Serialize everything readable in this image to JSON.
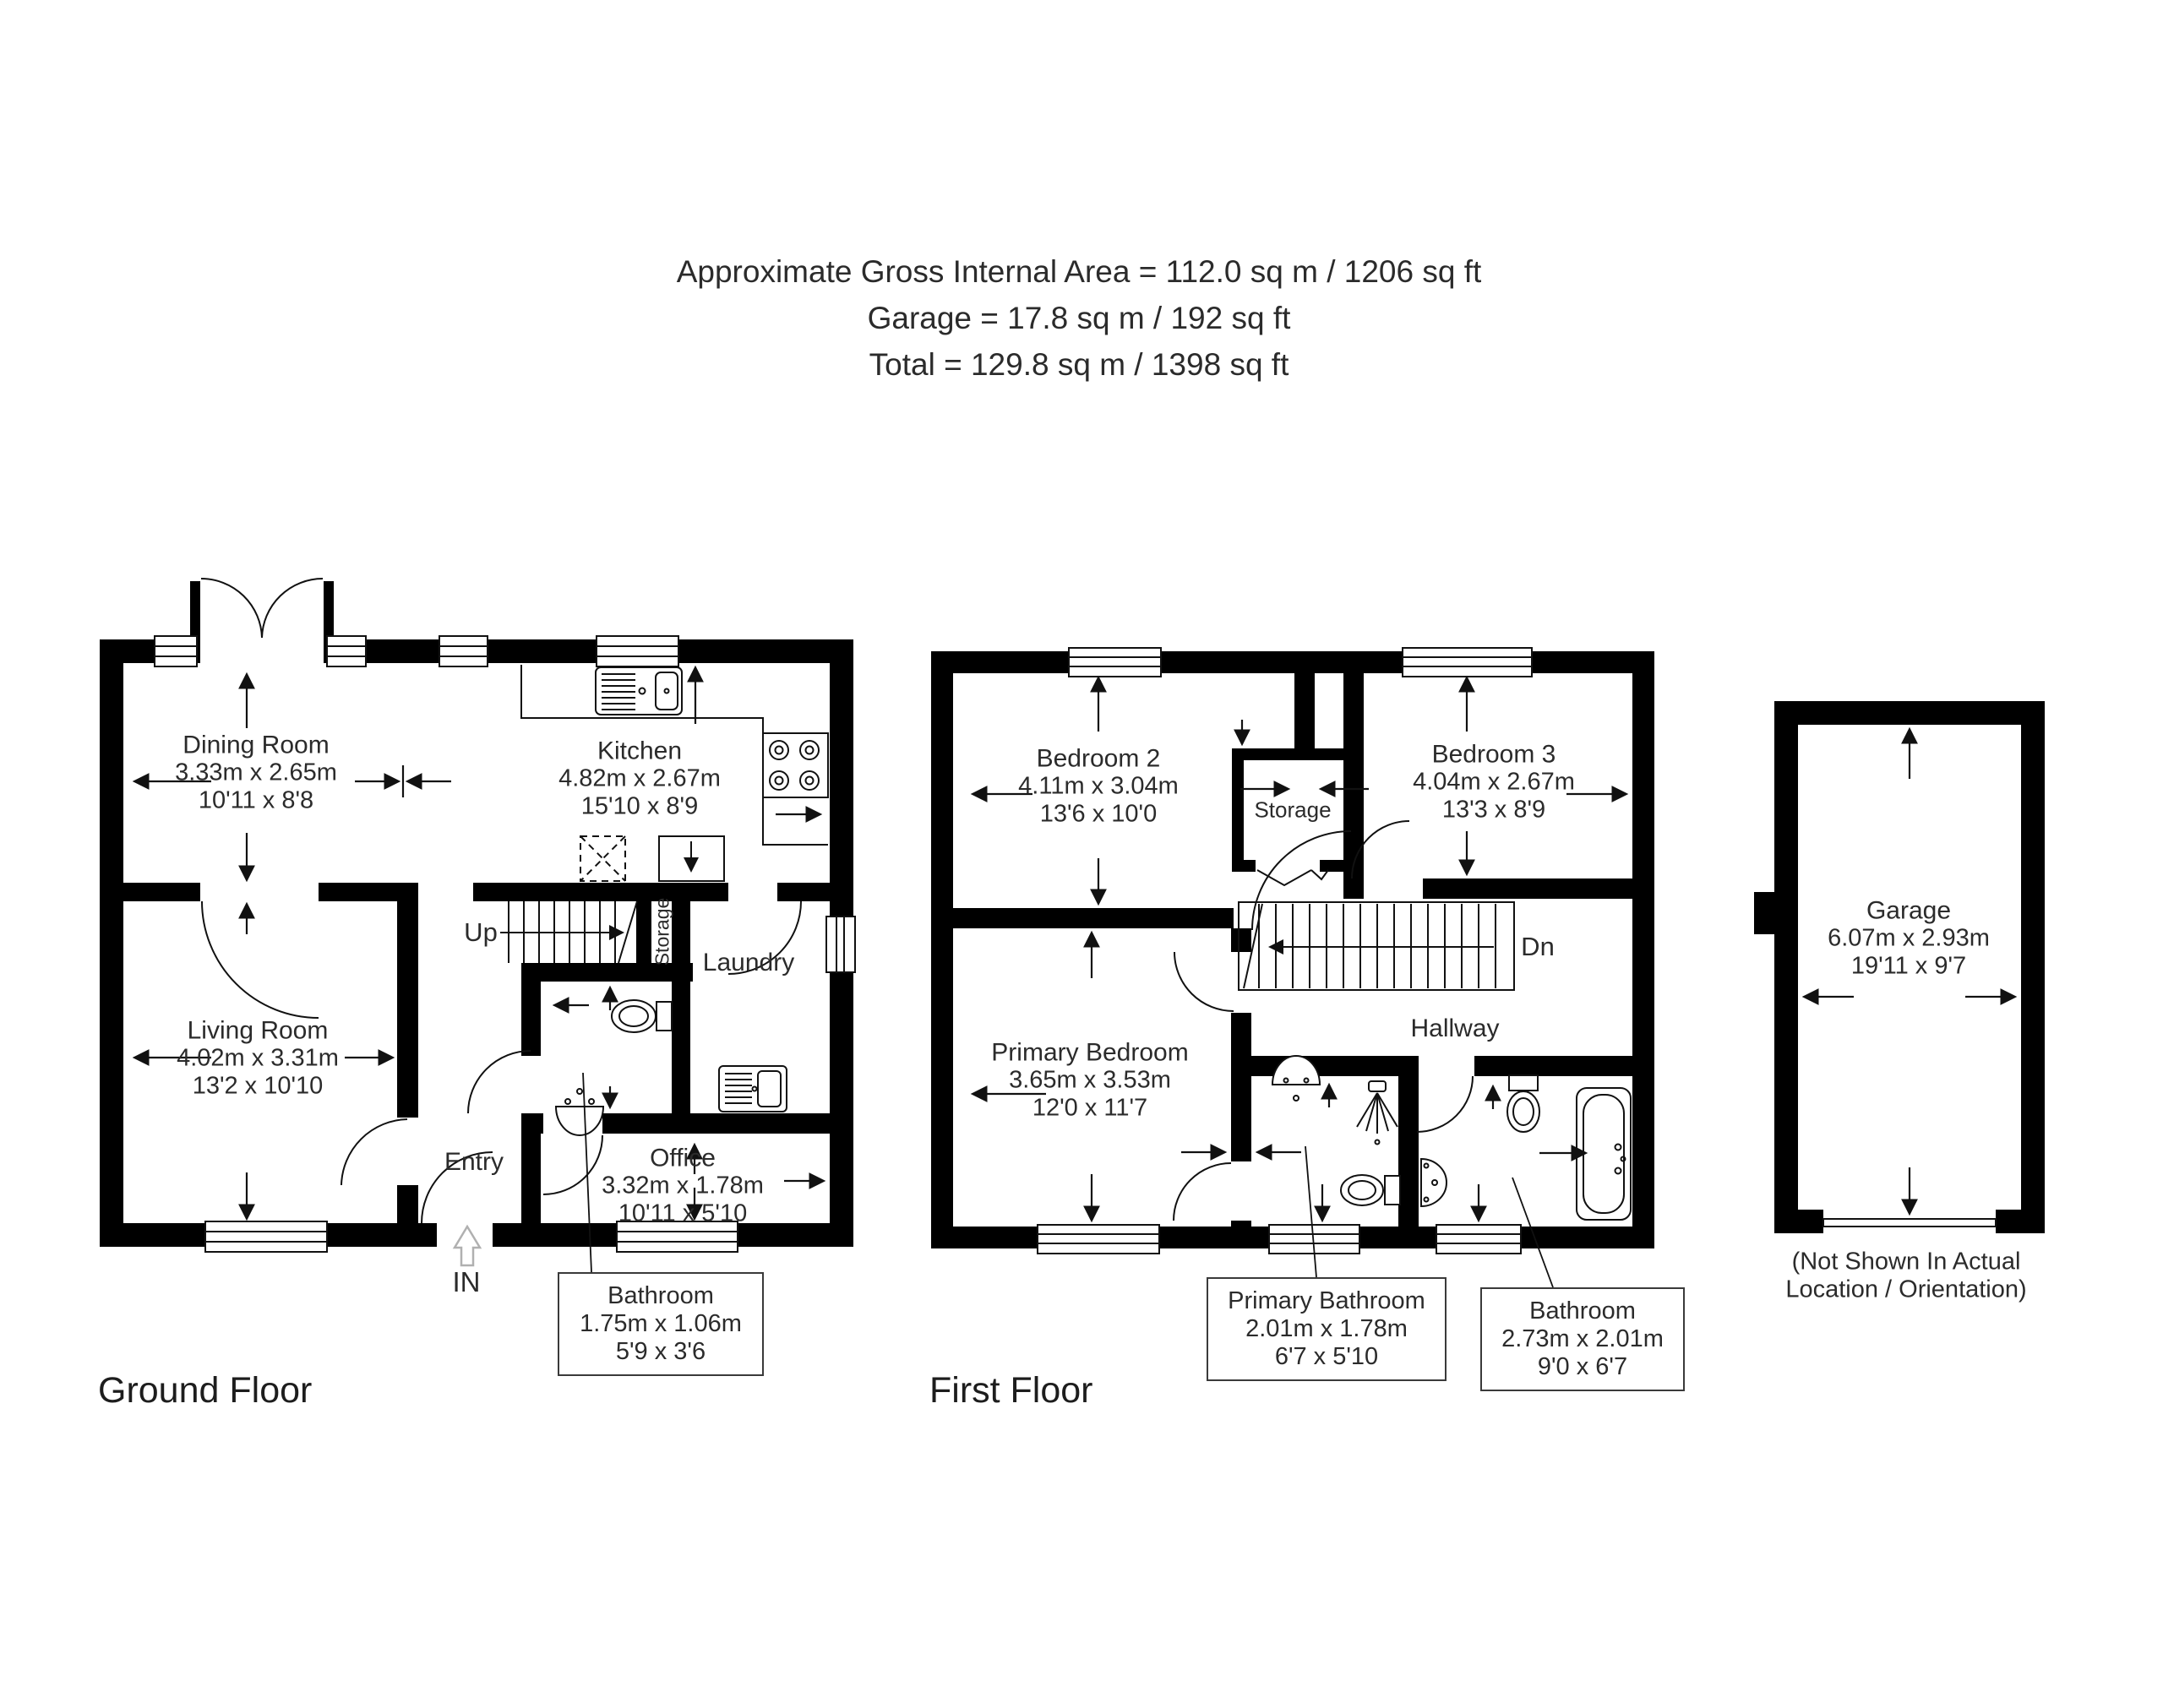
{
  "header": {
    "line1": "Approximate Gross Internal Area = 112.0 sq m / 1206 sq ft",
    "line2": "Garage = 17.8 sq m / 192 sq ft",
    "line3": "Total = 129.8 sq m / 1398 sq ft"
  },
  "ground_floor": {
    "title": "Ground Floor",
    "rooms": {
      "dining_room": {
        "name": "Dining Room",
        "metric": "3.33m x 2.65m",
        "imperial": "10'11 x 8'8"
      },
      "kitchen": {
        "name": "Kitchen",
        "metric": "4.82m x 2.67m",
        "imperial": "15'10 x 8'9"
      },
      "living_room": {
        "name": "Living Room",
        "metric": "4.02m x 3.31m",
        "imperial": "13'2 x 10'10"
      },
      "office": {
        "name": "Office",
        "metric": "3.32m x 1.78m",
        "imperial": "10'11 x 5'10"
      },
      "entry": {
        "name": "Entry"
      },
      "laundry": {
        "name": "Laundry"
      },
      "storage": {
        "name": "Storage"
      }
    },
    "stairs_label": "Up",
    "entrance_label": "IN",
    "callout": {
      "name": "Bathroom",
      "metric": "1.75m x 1.06m",
      "imperial": "5'9 x 3'6"
    }
  },
  "first_floor": {
    "title": "First Floor",
    "rooms": {
      "bedroom_2": {
        "name": "Bedroom 2",
        "metric": "4.11m x 3.04m",
        "imperial": "13'6 x 10'0"
      },
      "bedroom_3": {
        "name": "Bedroom 3",
        "metric": "4.04m x 2.67m",
        "imperial": "13'3 x 8'9"
      },
      "primary_bedroom": {
        "name": "Primary Bedroom",
        "metric": "3.65m x 3.53m",
        "imperial": "12'0 x 11'7"
      },
      "hallway": {
        "name": "Hallway"
      },
      "storage": {
        "name": "Storage"
      }
    },
    "stairs_label": "Dn",
    "callouts": {
      "primary_bathroom": {
        "name": "Primary Bathroom",
        "metric": "2.01m x 1.78m",
        "imperial": "6'7 x 5'10"
      },
      "bathroom": {
        "name": "Bathroom",
        "metric": "2.73m x 2.01m",
        "imperial": "9'0 x 6'7"
      }
    }
  },
  "garage": {
    "room": {
      "name": "Garage",
      "metric": "6.07m x 2.93m",
      "imperial": "19'11 x 9'7"
    },
    "note_line1": "(Not Shown In Actual",
    "note_line2": "Location / Orientation)"
  }
}
